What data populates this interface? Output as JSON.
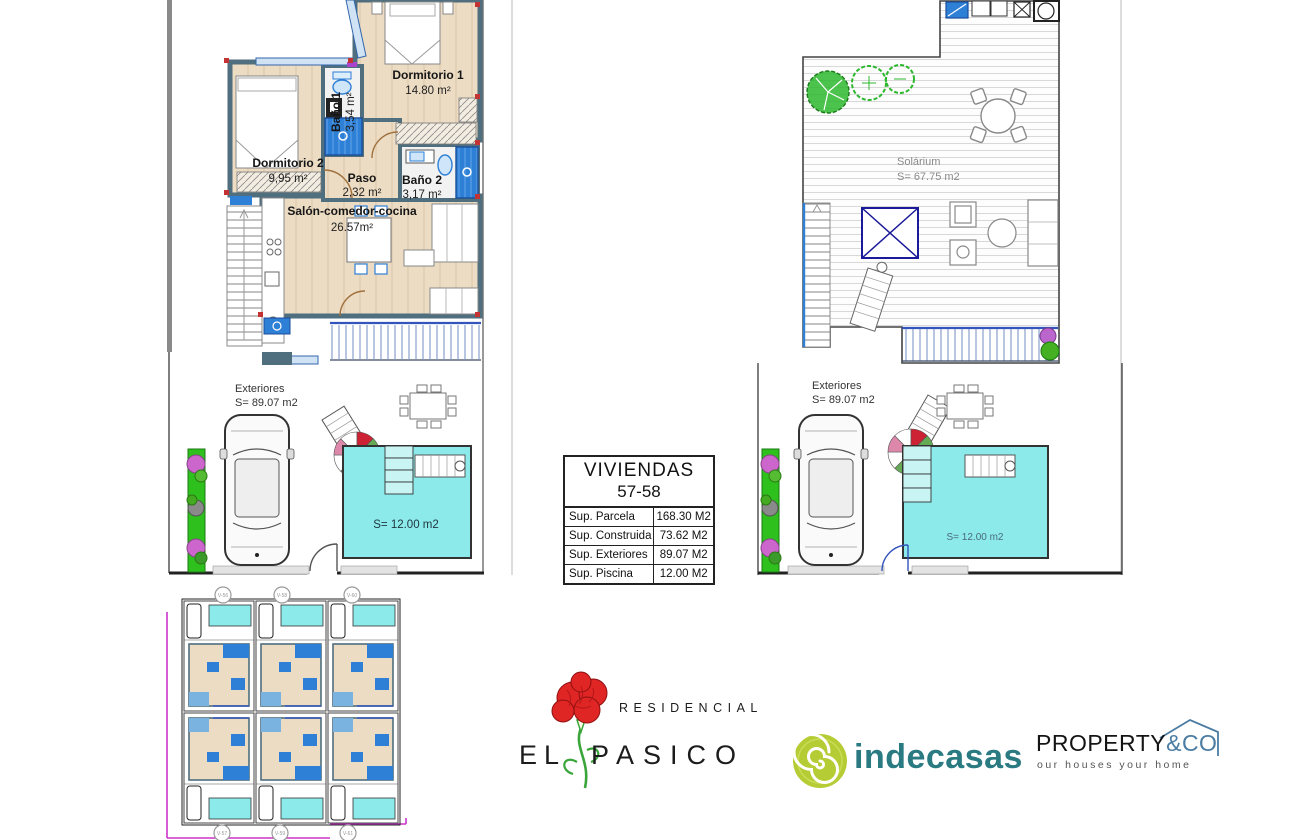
{
  "sheet": {
    "type": "architectural-plan-sheet"
  },
  "plan_left": {
    "rooms": [
      {
        "name": "Dormitorio 1",
        "area": "14.80 m²"
      },
      {
        "name": "Baño 1",
        "area": "3,54 m²"
      },
      {
        "name": "Dormitorio 2",
        "area": "9,95 m²"
      },
      {
        "name": "Paso",
        "area": "2,32 m²"
      },
      {
        "name": "Baño 2",
        "area": "3,17 m²"
      },
      {
        "name": "Salón-comedor-cocina",
        "area": "26.57m²"
      }
    ],
    "exterior": {
      "name": "Exteriores",
      "area": "S= 89.07 m2"
    },
    "pool_label": "S= 12.00 m2"
  },
  "plan_right": {
    "solarium": {
      "name": "Solárium",
      "area": "S= 67.75 m2"
    },
    "exterior": {
      "name": "Exteriores",
      "area": "S= 89.07 m2"
    },
    "pool_label": "S= 12.00 m2"
  },
  "summary_table": {
    "title_line1": "VIVIENDAS",
    "title_line2": "57-58",
    "rows": [
      {
        "label": "Sup. Parcela",
        "value": "168.30 M2"
      },
      {
        "label": "Sup. Construida",
        "value": "73.62 M2"
      },
      {
        "label": "Sup. Exteriores",
        "value": "89.07 M2"
      },
      {
        "label": "Sup. Piscina",
        "value": "12.00 M2"
      }
    ]
  },
  "site_plan": {
    "markers_top": [
      "V-56",
      "V-58",
      "V-60"
    ],
    "markers_bottom": [
      "V-57",
      "V-59",
      "V-61"
    ]
  },
  "logos": {
    "residencial": {
      "line1": "RESIDENCIAL",
      "word_start": "EL",
      "word_end": "PASICO"
    },
    "indecasas": {
      "name": "indecasas"
    },
    "property": {
      "name": "PROPERTY",
      "suffix": "&CO",
      "tagline": "our houses your home"
    }
  },
  "colors": {
    "wall": "#4f6e7e",
    "floor": "#ecdcc4",
    "fixture_blue": "#2e7fd6",
    "pool": "#8ceaea",
    "grass": "#2ec11e",
    "tree_green": "#2db82d",
    "railing_blue": "#3355bb",
    "pergola_navy": "#1b1b9a",
    "site_magenta": "#cc33cc",
    "flower_red": "#e02525",
    "stem_green": "#3aa53a",
    "indecasas_lime": "#b5cc34",
    "indecasas_teal": "#2a7a82",
    "property_blue": "#4a7ca3"
  }
}
